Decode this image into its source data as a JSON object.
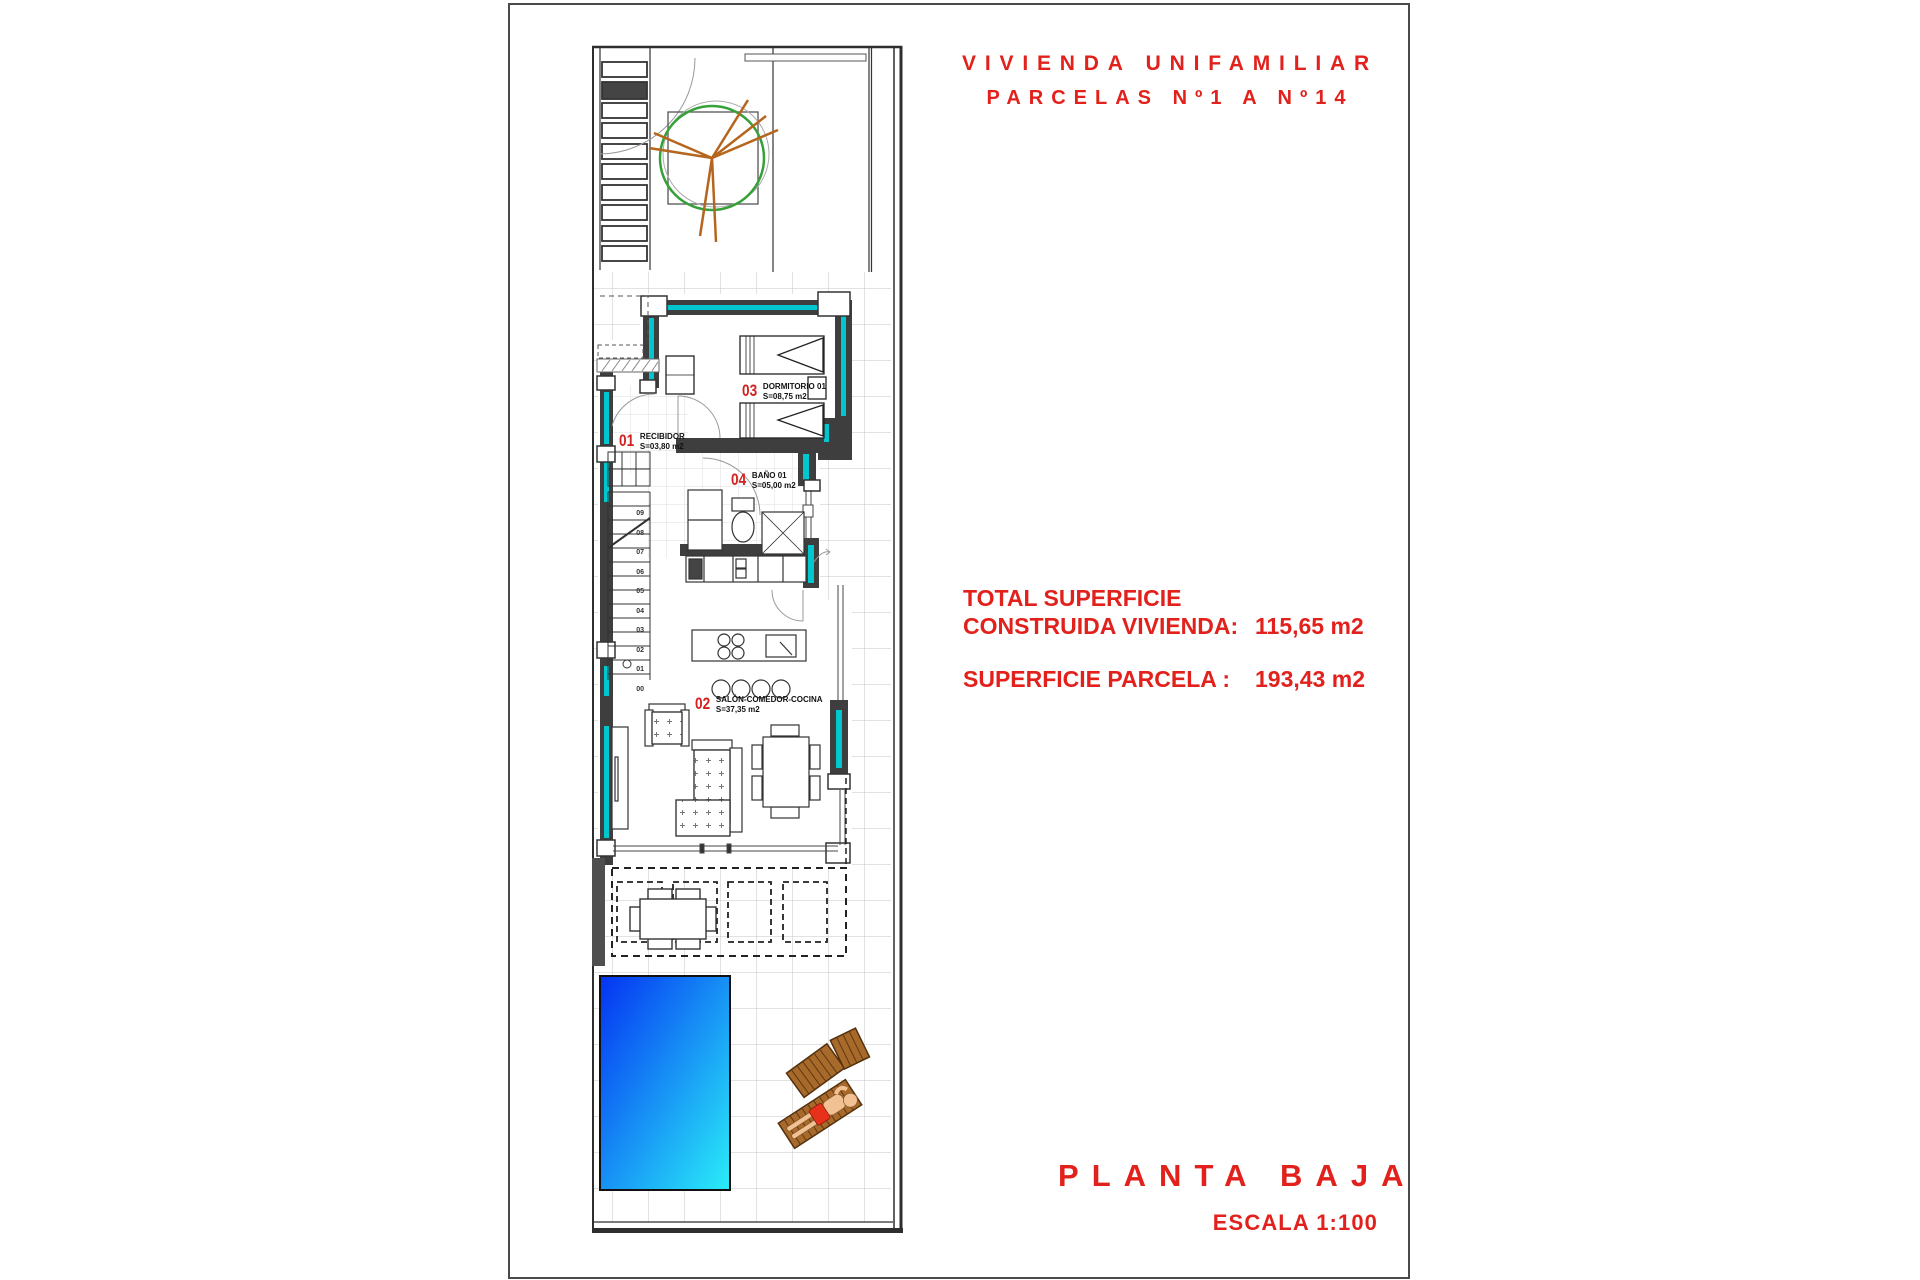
{
  "title": {
    "line1": "VIVIENDA UNIFAMILIAR",
    "line2": "PARCELAS Nº1 A Nº14"
  },
  "summary": {
    "label_line1": "TOTAL SUPERFICIE",
    "label_line2": "CONSTRUIDA VIVIENDA:",
    "value1": "115,65 m2",
    "label2": "SUPERFICIE PARCELA :",
    "value2": "193,43 m2"
  },
  "footer": {
    "plan_name": "PLANTA BAJA",
    "scale": "ESCALA 1:100"
  },
  "rooms": [
    {
      "num": "01",
      "name": "RECIBIDOR",
      "area": "S=03,80 m2"
    },
    {
      "num": "02",
      "name": "SALÓN-COMEDOR-COCINA",
      "area": "S=37,35 m2"
    },
    {
      "num": "03",
      "name": "DORMITORIO 01",
      "area": "S=08,75 m2"
    },
    {
      "num": "04",
      "name": "BAÑO 01",
      "area": "S=05,00 m2"
    }
  ],
  "stairs": {
    "steps": "09\n08\n07\n06\n05\n04\n03\n02\n01\n00"
  },
  "colors": {
    "red": "#e2211c",
    "wall": "#3e3e3e",
    "cyan": "#00c6d0",
    "pool_deep": "#0433f2",
    "pool_light": "#2aeef8",
    "wood": "#a76a2a",
    "tree_green": "#35a138",
    "branch": "#b5651d"
  }
}
